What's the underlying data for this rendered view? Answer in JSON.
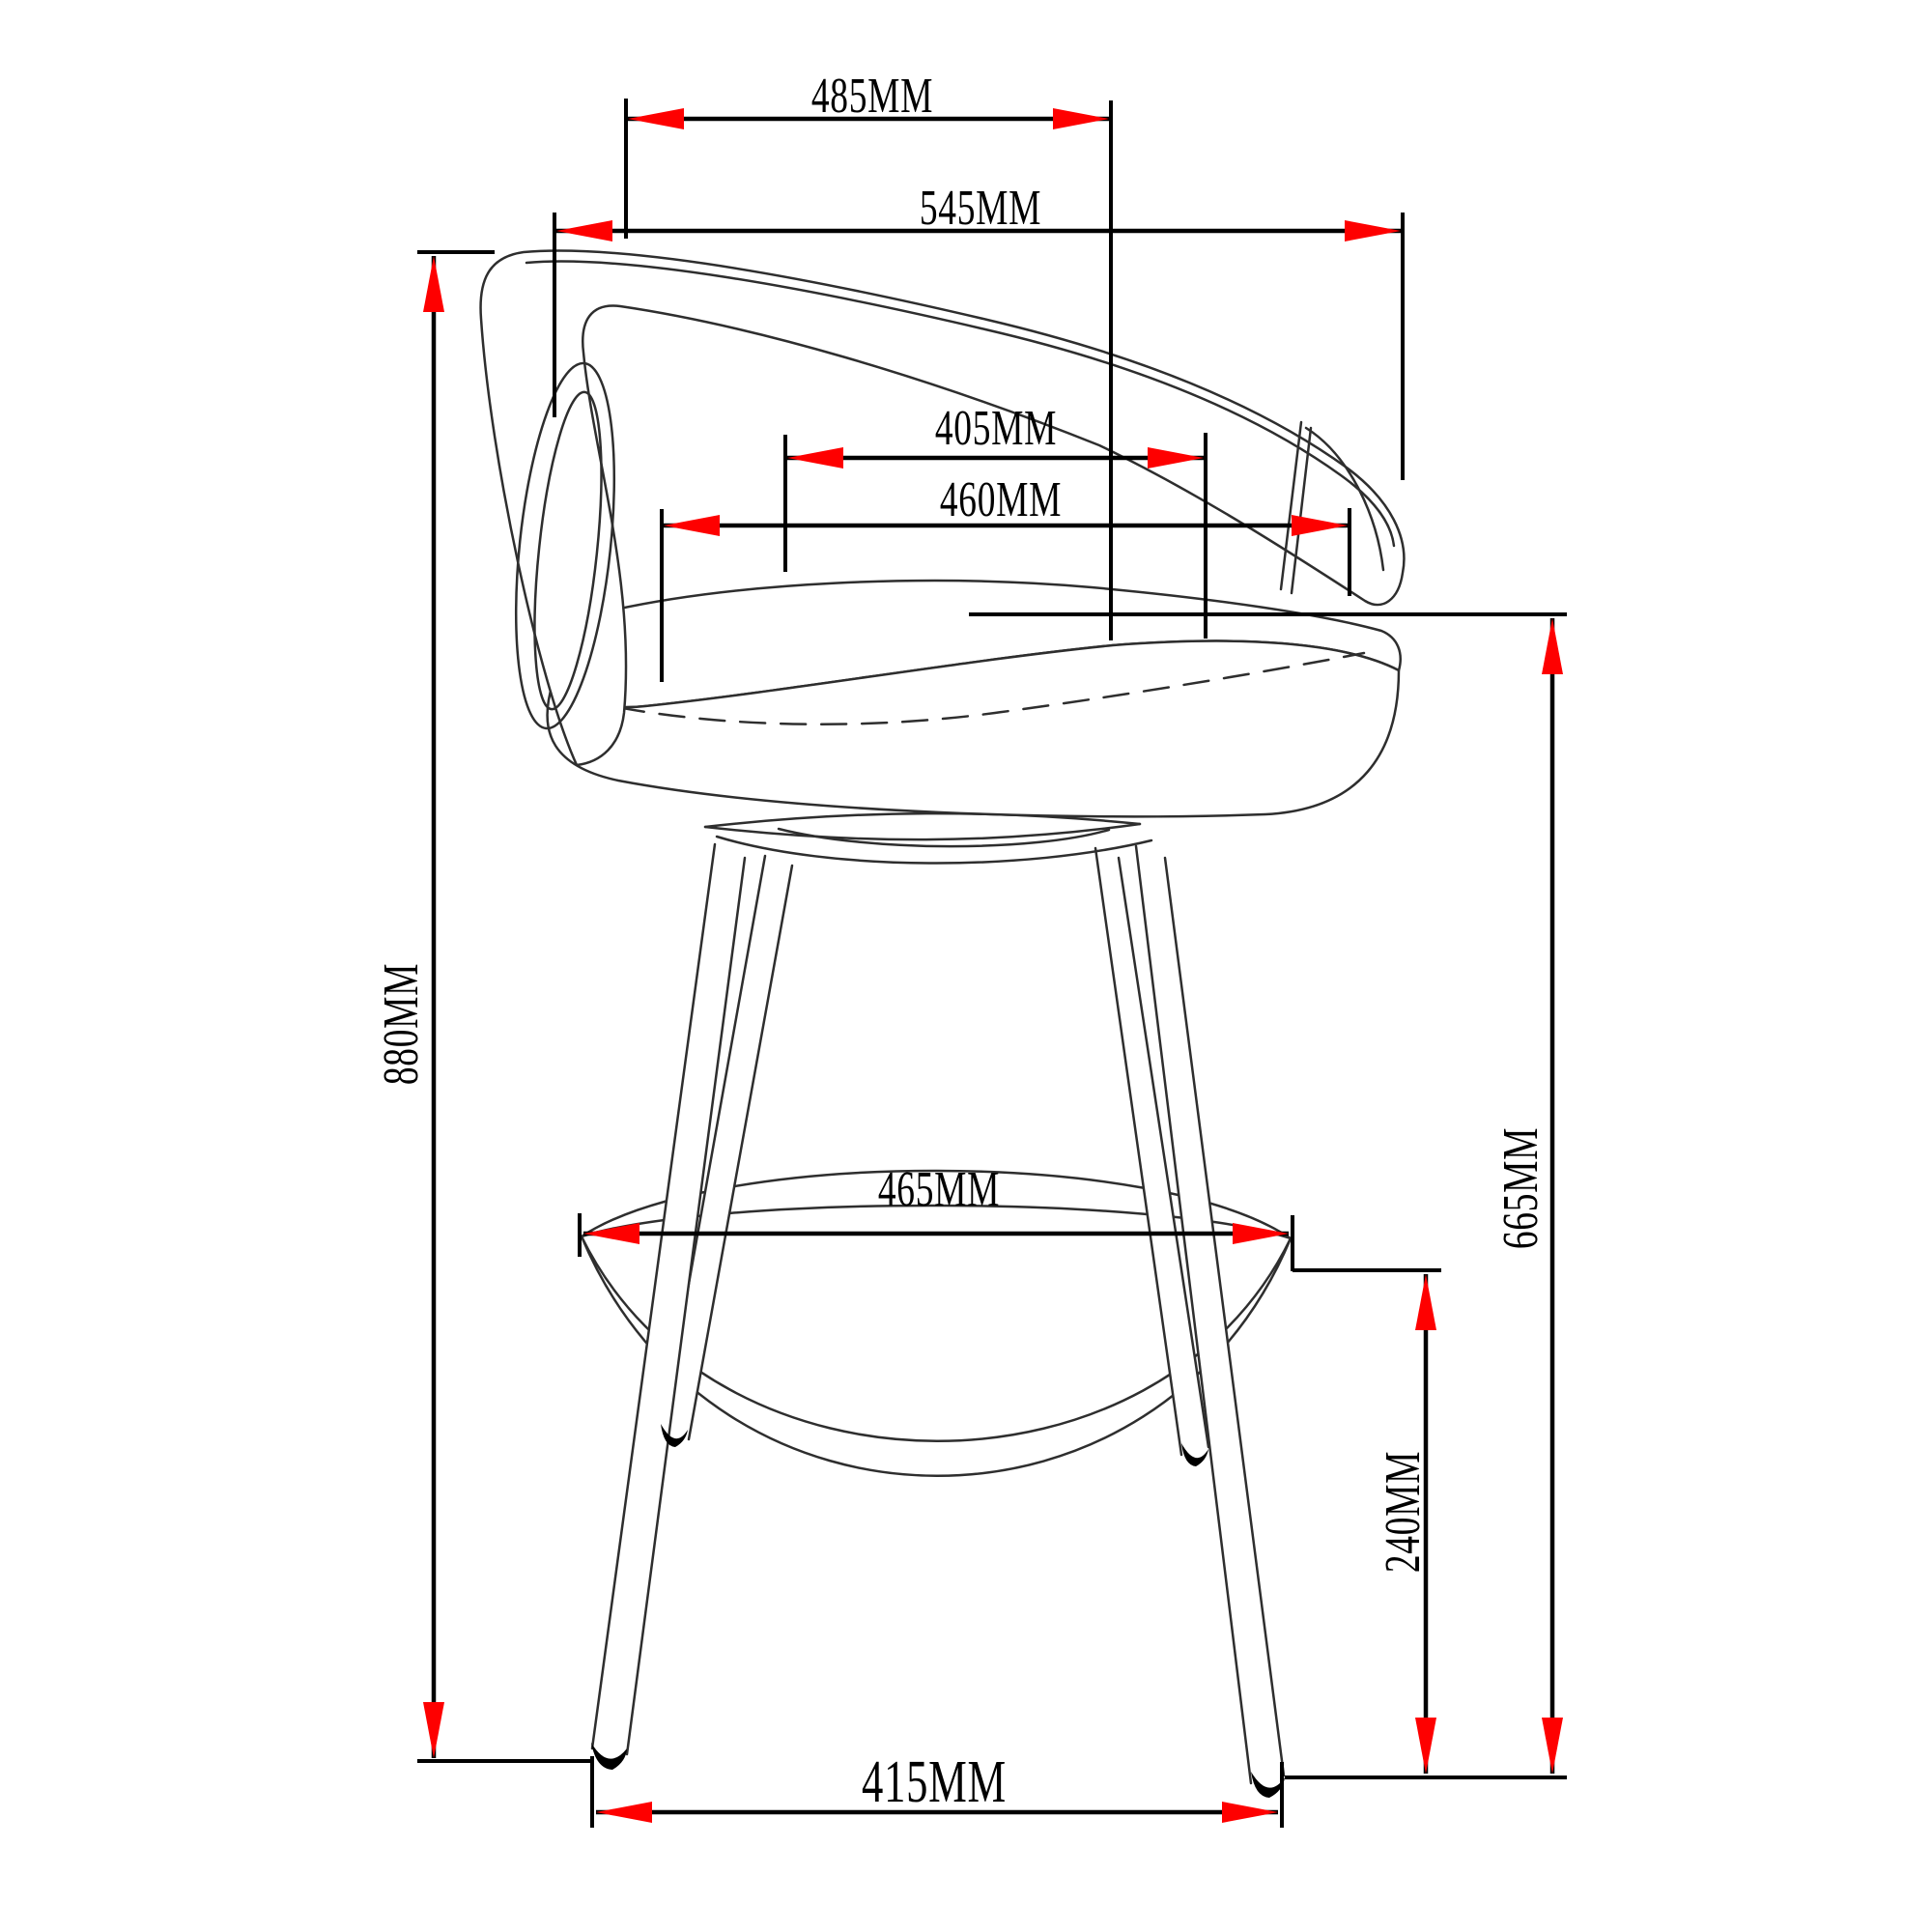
{
  "figure": {
    "type": "furniture-dimension-diagram",
    "units": "MM",
    "colors": {
      "background": "#ffffff",
      "dimension_lines": "#000000",
      "drawing_lines": "#2e2e2e",
      "arrows": "#fe0000"
    }
  },
  "dims": {
    "d485": {
      "label": "485MM",
      "value": 485,
      "unit": "MM",
      "orientation": "horizontal"
    },
    "d545": {
      "label": "545MM",
      "value": 545,
      "unit": "MM",
      "orientation": "horizontal"
    },
    "d405": {
      "label": "405MM",
      "value": 405,
      "unit": "MM",
      "orientation": "horizontal"
    },
    "d460": {
      "label": "460MM",
      "value": 460,
      "unit": "MM",
      "orientation": "horizontal"
    },
    "d880": {
      "label": "880MM",
      "value": 880,
      "unit": "MM",
      "orientation": "vertical"
    },
    "d665": {
      "label": "665MM",
      "value": 665,
      "unit": "MM",
      "orientation": "vertical"
    },
    "d465": {
      "label": "465MM",
      "value": 465,
      "unit": "MM",
      "orientation": "horizontal"
    },
    "d240": {
      "label": "240MM",
      "value": 240,
      "unit": "MM",
      "orientation": "vertical"
    },
    "d415": {
      "label": "415MM",
      "value": 415,
      "unit": "MM",
      "orientation": "horizontal"
    }
  },
  "stool_parts": [
    "backrest-band",
    "backrest-side-loop",
    "backrest-end-panel",
    "seat-cushion",
    "seat-piping-seam",
    "swivel-frame",
    "front-left-leg",
    "front-right-leg",
    "rear-left-leg",
    "rear-right-leg",
    "footrest-ring",
    "foot-caps"
  ]
}
